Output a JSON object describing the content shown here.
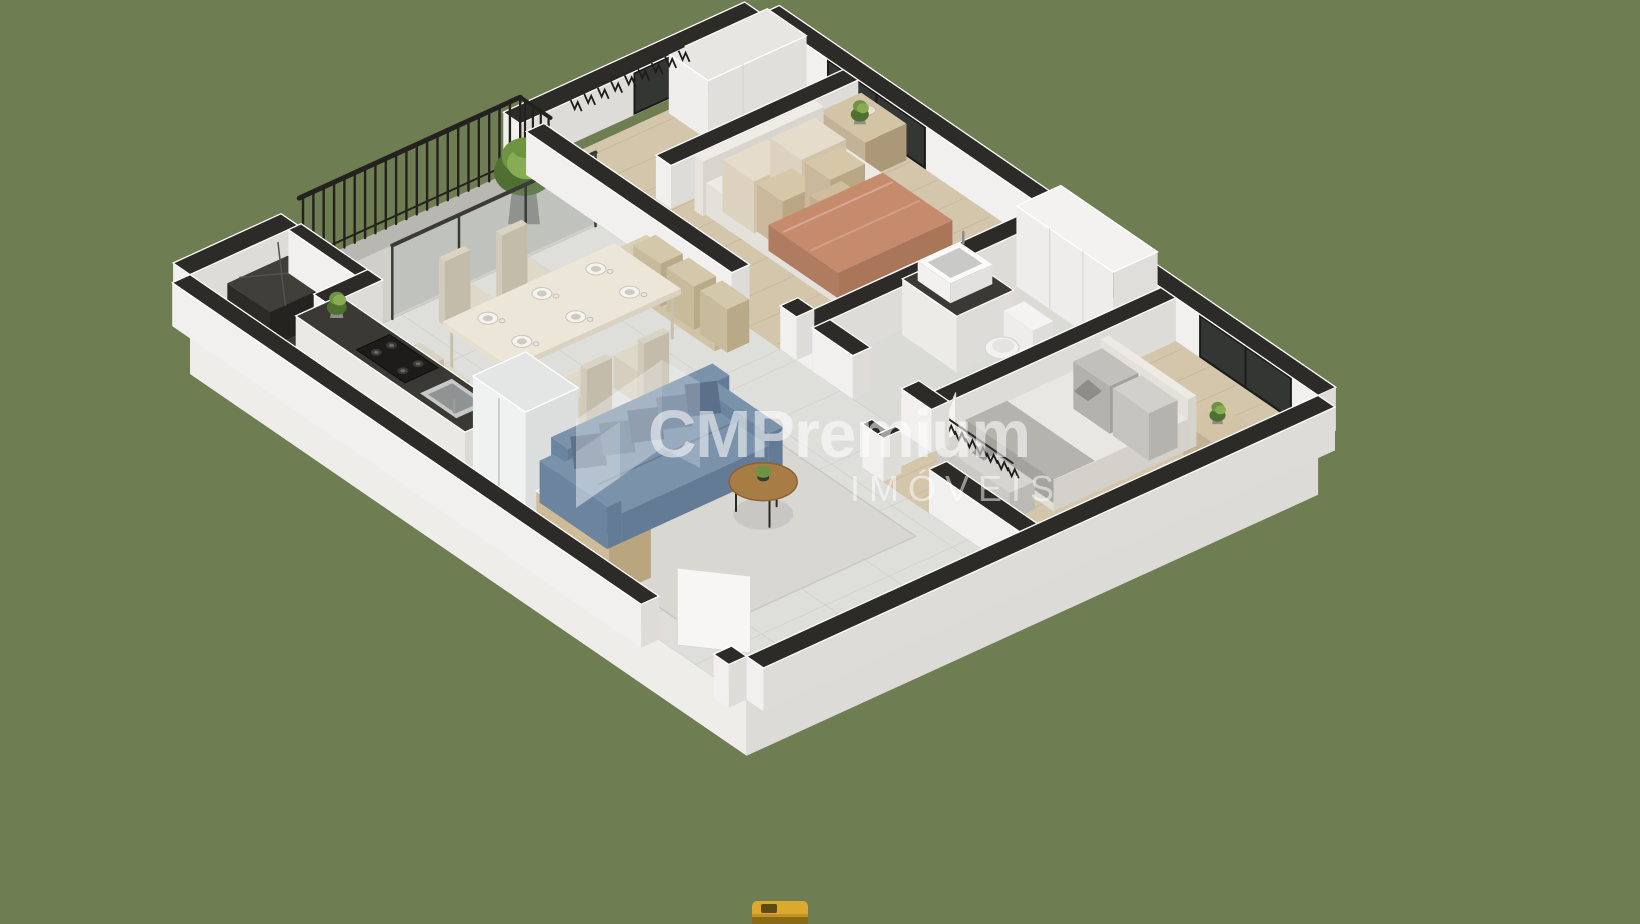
{
  "background_color": "#6f7e52",
  "watermark": {
    "brand": "CMPremium",
    "subtitle": "IMÓVEIS",
    "text_color": "#ffffff"
  },
  "scene": {
    "type": "isometric-3d-floor-plan",
    "rooms": [
      "balcony",
      "utility-area",
      "kitchen-dining",
      "living-room",
      "master-bedroom",
      "walk-in-closet",
      "bathroom",
      "second-bedroom",
      "entry-hall"
    ],
    "furniture": [
      "double-bed",
      "nightstand-with-plant",
      "hanging-clothes-rack",
      "balcony-plant",
      "dining-table-six-settings",
      "banquette-bench",
      "dining-chairs",
      "kitchen-counter-gas-cooktop",
      "kitchen-sink",
      "refrigerator",
      "sideboard-with-plates",
      "blue-sofa",
      "round-coffee-table",
      "bathroom-vanity-sink",
      "toilet",
      "linen-closet",
      "second-bed",
      "foot-bench",
      "second-nightstand-with-plant"
    ]
  },
  "palette": {
    "wall_top": "#2d2b27",
    "wall_bright": "#f1f0ee",
    "wall_shade": "#dddcd9",
    "slab_front": "#eeede9",
    "slab_side": "#dcdbd7",
    "floor_tile": "#dededa",
    "floor_balcony": "#d0cfca",
    "pebble_strip": "#b8b7b1",
    "floor_wood": "#d4c6aa",
    "floor_bath": "#dadad6",
    "floor_dark": "#3a3833",
    "rug": "#d9d7d2",
    "glass": "#343633",
    "frame_dark": "#1b1b19",
    "railing": "#23221f",
    "counter_top": "#3b3934",
    "stove": "#1d1c1a",
    "metal": "#c6c8c8",
    "metal_dark": "#8f9393",
    "wood": "#c3b396",
    "wood_dark": "#ab9878",
    "wood_top": "#d3c4a6",
    "table_top": "#ece6d8",
    "chair": "#d6cfbf",
    "sofa_front": "#6d849e",
    "sofa_side": "#647b95",
    "sofa_top": "#7b92ab",
    "sofa_pillow": "#5c7089",
    "blanket": "#c68b6c",
    "blanket_dark": "#b07c5f",
    "duvet": "#edeae4",
    "pillow_cream": "#dcd2bf",
    "pillow_tan": "#c9b89b",
    "bed_gray": "#b5b3ae",
    "green_dark": "#4f7030",
    "green": "#6d9440",
    "green_light": "#88ac53",
    "fixture_white": "#f2f1ef",
    "coffee_table": "#a87c45",
    "accent_yellow": "#dba92d"
  }
}
